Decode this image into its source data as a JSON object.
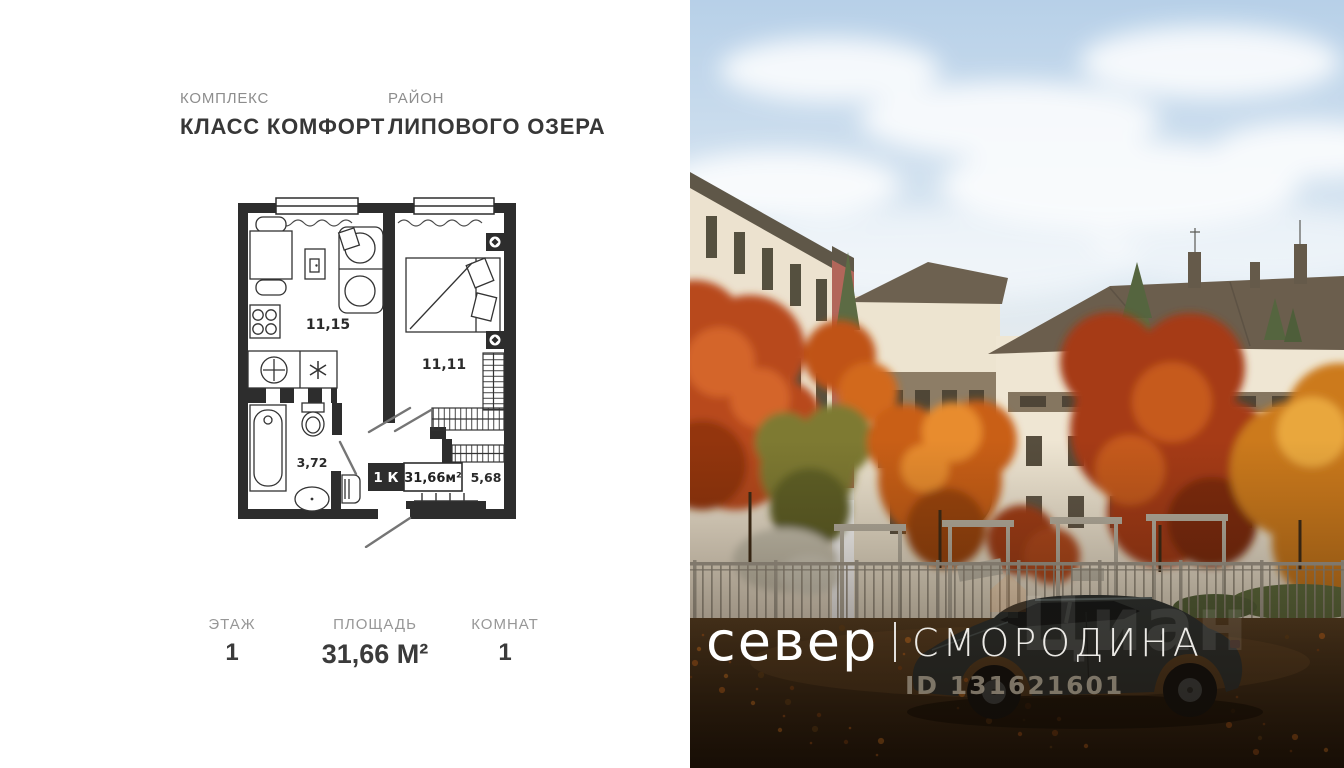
{
  "palette": {
    "plan_wall": "#2d2d2d",
    "text_dark": "#3a3a3a",
    "text_muted": "#8f8f8f",
    "photo_text": "#ffffff",
    "autumn_accent": "#c25a1d",
    "roof_brown": "#6b5e4d",
    "facade_cream": "#ece3d1"
  },
  "header": {
    "complex_label": "КОМПЛЕКС",
    "complex_name": "КЛАСС КОМФОРТ",
    "district_label": "РАЙОН",
    "district_name": "ЛИПОВОГО ОЗЕРА"
  },
  "plan": {
    "areas": {
      "living": "11,15",
      "bedroom": "11,11",
      "bathroom": "3,72",
      "hall": "5,68"
    },
    "badge": {
      "rooms": "1 К",
      "total_area": "31,66м²"
    }
  },
  "stats": [
    {
      "label": "ЭТАЖ",
      "value": "1"
    },
    {
      "label": "ПЛОЩАДЬ",
      "value": "31,66 М²"
    },
    {
      "label": "КОМНАТ",
      "value": "1"
    }
  ],
  "photo": {
    "brand": "север",
    "divider": "|",
    "project": "СМОРОДИНА",
    "watermark_logo": "Циан",
    "watermark_id": "ID 131621601"
  }
}
